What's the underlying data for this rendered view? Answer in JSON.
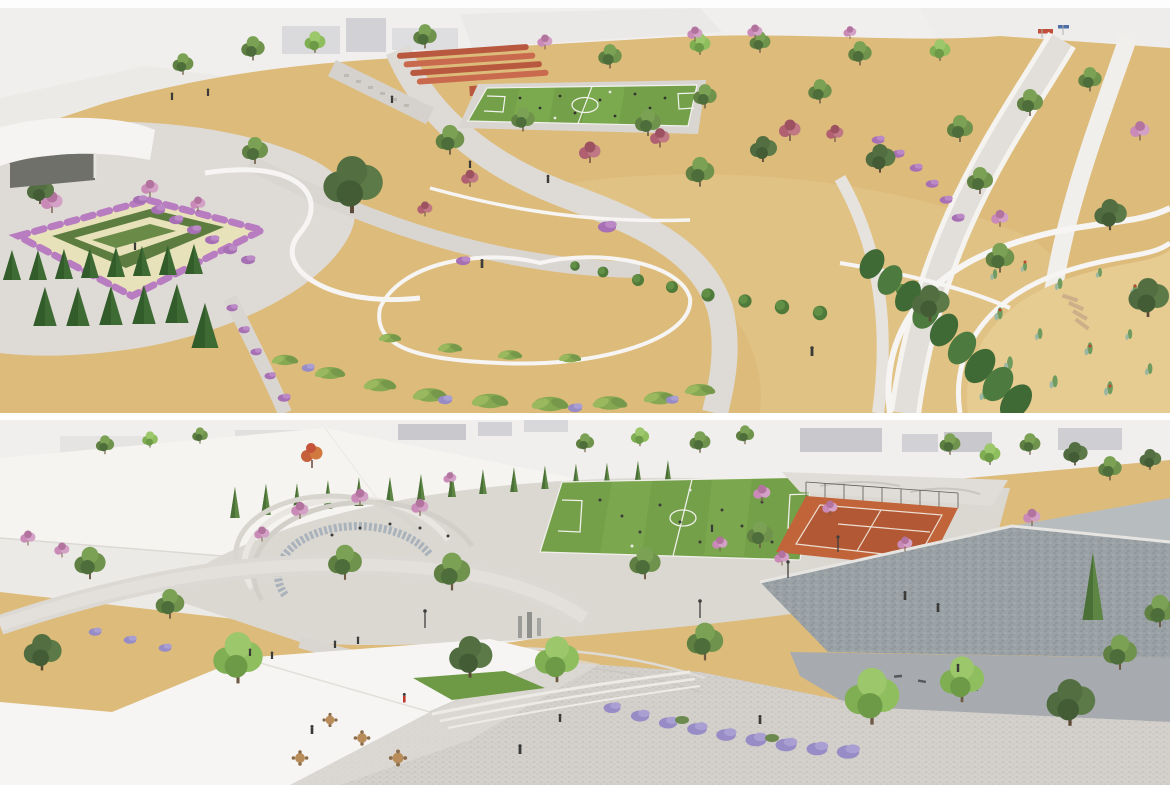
{
  "meta": {
    "title": "Park masterplan aerial renderings",
    "media_type": "architectural 3D rendering, two stacked aerial views",
    "panel_count": 2
  },
  "panels": {
    "top": {
      "name": "top-aerial-render",
      "description": "Aerial rendering of a park: central soccer pitch with running track lanes, sandy gardens with olive and pink flowering trees, curving white garden walls with topiary balls and grass beds, flower parterre and cypress grove at lower left, cactus garden with curved white ramps at right, white pavilion at left",
      "elements": [
        "soccer-field",
        "running-track",
        "flower-parterre",
        "conifer-grove",
        "cactus-garden",
        "curved-white-walls",
        "pavilion",
        "paths",
        "trees",
        "purple-hedges"
      ]
    },
    "bottom": {
      "name": "bottom-aerial-render",
      "description": "Aerial rendering of the same park from another angle: white canopy roofs with cypress row at left, soccer pitch and clay sports court with fence, skate area, amphitheater steps with mosaic band, cobbled plaza foreground, curved lavender hedges, large gabion stone wall at right",
      "elements": [
        "canopy-roofs",
        "cypress-row",
        "soccer-field",
        "clay-court",
        "skate-area",
        "amphitheater",
        "cobble-plaza",
        "lavender-hedge",
        "gabion-wall",
        "cafe-tables",
        "lawn-patch",
        "trees"
      ]
    }
  },
  "palette": {
    "sky": "#f1efed",
    "building_gray": "#c9c9cd",
    "building_light": "#e5e3e2",
    "sand": "#ddbb7a",
    "sand_light": "#e7cc92",
    "path_light": "#dedbd6",
    "plaza_cobble": "#d4d1cc",
    "field_green": "#73a048",
    "track_red": "#b8583e",
    "court_clay": "#c2643a",
    "wall_white": "#f6f5f3",
    "stone_wall": "#9ba2a6",
    "stone_wall_light": "#b7bcbe",
    "conifer_green": "#3e6b34",
    "tree_green": "#67874a",
    "tree_green_bright": "#7fae53",
    "pink_bloom": "#c583b4",
    "red_pink_foliage": "#b06070",
    "purple_hedge": "#a770b5",
    "lavender": "#978cc6",
    "flower_cream": "#e8e2ba",
    "water_tile": "#aab3bb",
    "trunk_brown": "#6e5a43",
    "figure_red": "#c0392b"
  }
}
